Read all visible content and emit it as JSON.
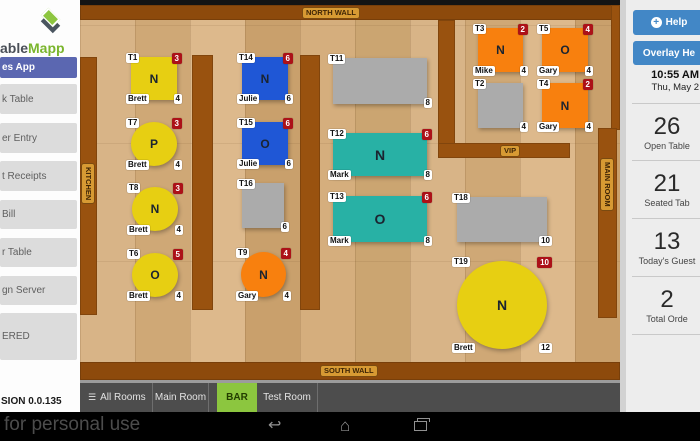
{
  "colors": {
    "yellow": "#e7cf12",
    "blue": "#1f57d6",
    "orange": "#f8800e",
    "teal": "#28b1a5",
    "gray": "#ababab",
    "badge_red": "#ac1118",
    "accent_blue": "#4287c6",
    "accent_green": "#8cc63f",
    "active_item_blue": "#5b67b1"
  },
  "left_sidebar": {
    "logo_dark": "able",
    "logo_green": "Mapp",
    "items": [
      {
        "label": "es App",
        "active": true,
        "top": 57,
        "height": 21
      },
      {
        "label": "k Table",
        "top": 84,
        "height": 30
      },
      {
        "label": "er Entry",
        "top": 123,
        "height": 30
      },
      {
        "label": "t Receipts",
        "top": 161,
        "height": 30
      },
      {
        "label": "Bill",
        "top": 200,
        "height": 29
      },
      {
        "label": "r Table",
        "top": 238,
        "height": 29
      },
      {
        "label": "gn Server",
        "top": 276,
        "height": 29
      },
      {
        "label": "ERED",
        "top": 313,
        "height": 47
      }
    ],
    "version": "SION 0.0.135"
  },
  "floor": {
    "wall_labels": {
      "north": "NORTH WALL",
      "south": "SOUTH WALL",
      "kitchen": "KITCHEN",
      "main_room": "MAIN ROOM",
      "vip": "VIP"
    },
    "tables": [
      {
        "id": "T1",
        "shape": "square",
        "color": "yellow",
        "letter": "N",
        "server": "Brett",
        "seats": "4",
        "badge": "3",
        "x": 51,
        "y": 57,
        "w": 46,
        "h": 43
      },
      {
        "id": "T7",
        "shape": "circle",
        "color": "yellow",
        "letter": "P",
        "server": "Brett",
        "seats": "4",
        "badge": "3",
        "x": 51,
        "y": 122,
        "w": 46,
        "h": 44
      },
      {
        "id": "T8",
        "shape": "circle",
        "color": "yellow",
        "letter": "N",
        "server": "Brett",
        "seats": "4",
        "badge": "3",
        "x": 52,
        "y": 187,
        "w": 46,
        "h": 44
      },
      {
        "id": "T6",
        "shape": "circle",
        "color": "yellow",
        "letter": "O",
        "server": "Brett",
        "seats": "4",
        "badge": "5",
        "x": 52,
        "y": 253,
        "w": 46,
        "h": 44
      },
      {
        "id": "T14",
        "shape": "square",
        "color": "blue",
        "letter": "N",
        "server": "Julie",
        "seats": "6",
        "badge": "6",
        "x": 162,
        "y": 57,
        "w": 46,
        "h": 43
      },
      {
        "id": "T15",
        "shape": "square",
        "color": "blue",
        "letter": "O",
        "server": "Julie",
        "seats": "6",
        "badge": "6",
        "x": 162,
        "y": 122,
        "w": 46,
        "h": 43
      },
      {
        "id": "T16",
        "shape": "square",
        "color": "gray",
        "letter": "",
        "server": "",
        "seats": "6",
        "badge": "",
        "x": 162,
        "y": 183,
        "w": 42,
        "h": 45
      },
      {
        "id": "T9",
        "shape": "circle",
        "color": "orange",
        "letter": "N",
        "server": "Gary",
        "seats": "4",
        "badge": "4",
        "x": 161,
        "y": 252,
        "w": 45,
        "h": 45
      },
      {
        "id": "T11",
        "shape": "rect",
        "color": "gray",
        "letter": "",
        "server": "",
        "seats": "8",
        "badge": "",
        "x": 253,
        "y": 58,
        "w": 94,
        "h": 46
      },
      {
        "id": "T12",
        "shape": "rect",
        "color": "teal",
        "letter": "N",
        "server": "Mark",
        "seats": "8",
        "badge": "6",
        "x": 253,
        "y": 133,
        "w": 94,
        "h": 43
      },
      {
        "id": "T13",
        "shape": "rect",
        "color": "teal",
        "letter": "O",
        "server": "Mark",
        "seats": "8",
        "badge": "6",
        "x": 253,
        "y": 196,
        "w": 94,
        "h": 46
      },
      {
        "id": "T18",
        "shape": "rect",
        "color": "gray",
        "letter": "",
        "server": "",
        "seats": "10",
        "badge": "",
        "x": 377,
        "y": 197,
        "w": 90,
        "h": 45
      },
      {
        "id": "T19",
        "shape": "circle",
        "color": "yellow",
        "letter": "N",
        "server": "Brett",
        "seats": "12",
        "badge": "10",
        "x": 377,
        "y": 261,
        "w": 90,
        "h": 88
      },
      {
        "id": "T3",
        "shape": "square",
        "color": "orange",
        "letter": "N",
        "server": "Mike",
        "seats": "4",
        "badge": "2",
        "x": 398,
        "y": 28,
        "w": 45,
        "h": 44
      },
      {
        "id": "T5",
        "shape": "square",
        "color": "orange",
        "letter": "O",
        "server": "Gary",
        "seats": "4",
        "badge": "4",
        "x": 462,
        "y": 28,
        "w": 46,
        "h": 44
      },
      {
        "id": "T2",
        "shape": "square",
        "color": "gray",
        "letter": "",
        "server": "",
        "seats": "4",
        "badge": "",
        "x": 398,
        "y": 83,
        "w": 45,
        "h": 45
      },
      {
        "id": "T4",
        "shape": "square",
        "color": "orange",
        "letter": "N",
        "server": "Gary",
        "seats": "4",
        "badge": "2",
        "x": 462,
        "y": 83,
        "w": 46,
        "h": 45
      }
    ]
  },
  "tabs": [
    {
      "key": "all_rooms",
      "label": "All Rooms",
      "icon": "hamburger",
      "active": false
    },
    {
      "key": "main_room",
      "label": "Main Room",
      "active": false
    },
    {
      "key": "bar",
      "label": "BAR",
      "active": true
    },
    {
      "key": "test_room",
      "label": "Test Room",
      "active": false
    }
  ],
  "right_sidebar": {
    "help_label": "Help",
    "overlay_label": "Overlay He",
    "time": "10:55 AM",
    "date": "Thu, May 2",
    "stats": [
      {
        "value": "26",
        "label": "Open Table"
      },
      {
        "value": "21",
        "label": "Seated Tab"
      },
      {
        "value": "13",
        "label": "Today's Guest"
      },
      {
        "value": "2",
        "label": "Total Orde"
      }
    ]
  },
  "navbar": {
    "watermark": "for personal use"
  }
}
